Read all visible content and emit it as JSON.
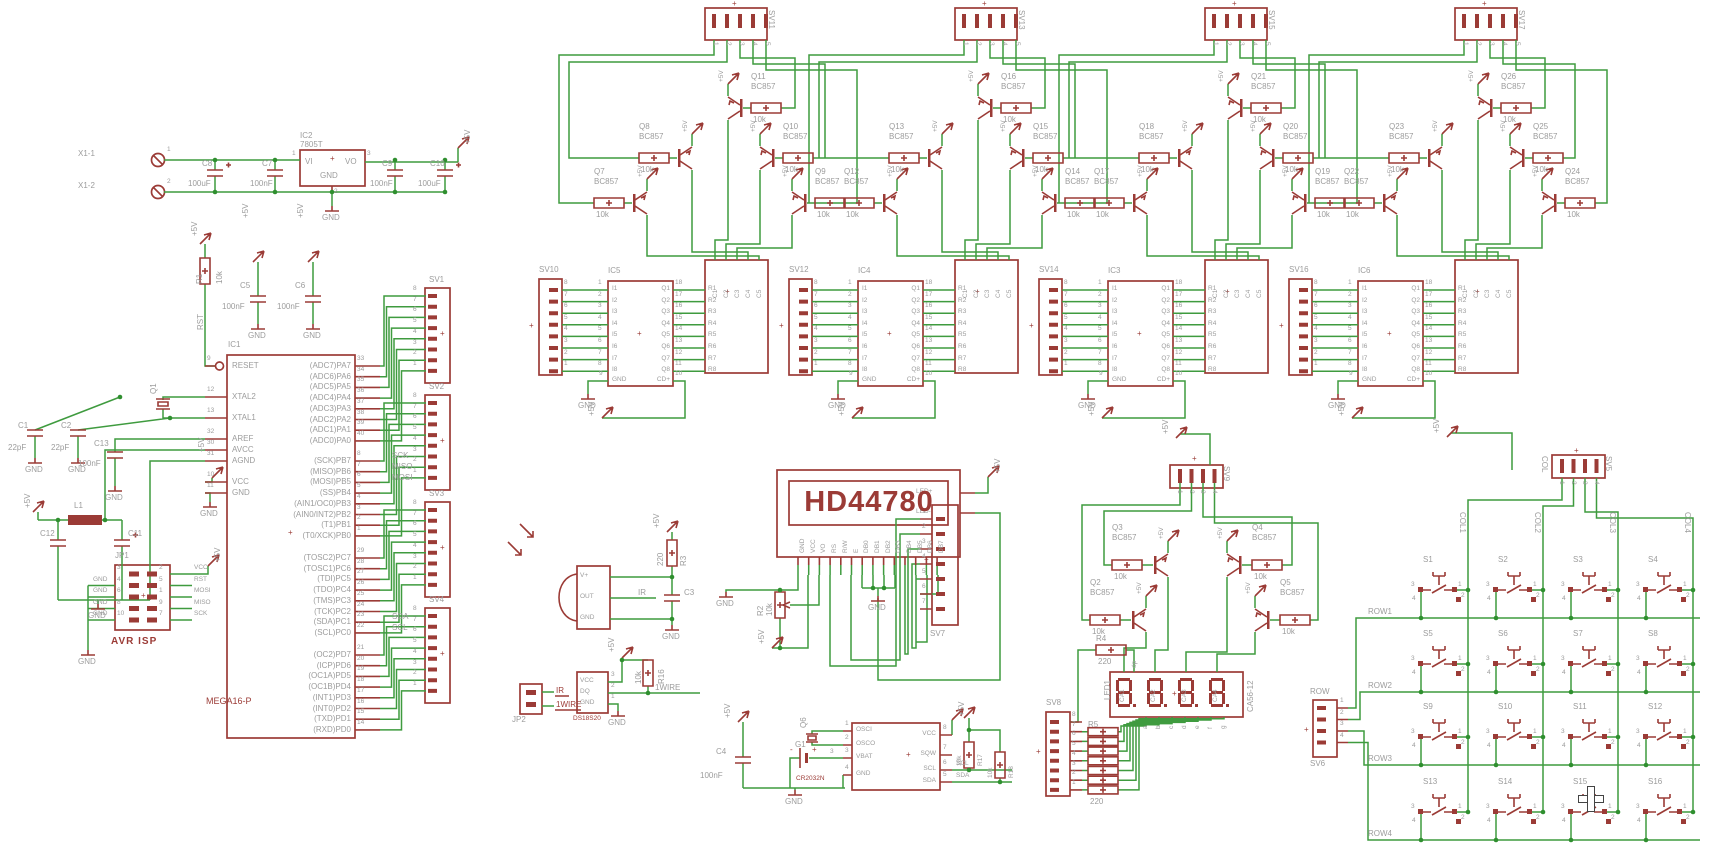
{
  "nets": {
    "p5v": "+5V",
    "gnd": "GND",
    "rst": "RST",
    "sck": "SCK",
    "miso": "MISO",
    "mosi": "MOSI",
    "sda": "SDA",
    "scl": "SCL",
    "ir": "IR",
    "w1": "1WIRE",
    "dp": "dp",
    "plus": "+",
    "minus": "-"
  },
  "power": {
    "x1a": "X1-1",
    "x1b": "X1-2",
    "n1": "1",
    "n2": "2",
    "ic2": {
      "ref": "IC2",
      "value": "7805T",
      "vi": "VI",
      "vo": "VO",
      "gnd": "GND",
      "nvi": "1",
      "nvo": "3",
      "ngnd": "2"
    },
    "c8": [
      "C8",
      "100uF"
    ],
    "c7": [
      "C7",
      "100nF"
    ],
    "c9": [
      "C9",
      "100nF"
    ],
    "c10": [
      "C10",
      "100uF"
    ]
  },
  "reset": {
    "ref": "R1",
    "value": "10k"
  },
  "dec": {
    "c5": [
      "C5",
      "100nF"
    ],
    "c6": [
      "C6",
      "100nF"
    ]
  },
  "mcu": {
    "ref": "IC1",
    "value": "MEGA16-P",
    "left": [
      [
        "9",
        "RESET"
      ],
      [
        "12",
        "XTAL2"
      ],
      [
        "13",
        "XTAL1"
      ],
      [
        "32",
        "AREF"
      ],
      [
        "30",
        "AVCC"
      ],
      [
        "31",
        "AGND"
      ],
      [
        "10",
        "VCC"
      ],
      [
        "11",
        "GND"
      ]
    ],
    "pa": [
      [
        "(ADC7)PA7",
        "33"
      ],
      [
        "(ADC6)PA6",
        "34"
      ],
      [
        "(ADC5)PA5",
        "35"
      ],
      [
        "(ADC4)PA4",
        "36"
      ],
      [
        "(ADC3)PA3",
        "37"
      ],
      [
        "(ADC2)PA2",
        "38"
      ],
      [
        "(ADC1)PA1",
        "39"
      ],
      [
        "(ADC0)PA0",
        "40"
      ]
    ],
    "pb": [
      [
        "(SCK)PB7",
        "8"
      ],
      [
        "(MISO)PB6",
        "7"
      ],
      [
        "(MOSI)PB5",
        "6"
      ],
      [
        "(SS)PB4",
        "5"
      ],
      [
        "(AIN1/OC0)PB3",
        "4"
      ],
      [
        "(AIN0/INT2)PB2",
        "3"
      ],
      [
        "(T1)PB1",
        "2"
      ],
      [
        "(T0/XCK)PB0",
        "1"
      ]
    ],
    "pc": [
      [
        "(TOSC2)PC7",
        "29"
      ],
      [
        "(TOSC1)PC6",
        "28"
      ],
      [
        "(TDI)PC5",
        "27"
      ],
      [
        "(TDO)PC4",
        "26"
      ],
      [
        "(TMS)PC3",
        "25"
      ],
      [
        "(TCK)PC2",
        "24"
      ],
      [
        "(SDA)PC1",
        "23"
      ],
      [
        "(SCL)PC0",
        "22"
      ]
    ],
    "pd": [
      [
        "(OC2)PD7",
        "21"
      ],
      [
        "(ICP)PD6",
        "20"
      ],
      [
        "(OC1A)PD5",
        "19"
      ],
      [
        "(OC1B)PD4",
        "18"
      ],
      [
        "(INT1)PD3",
        "17"
      ],
      [
        "(INT0)PD2",
        "16"
      ],
      [
        "(TXD)PD1",
        "15"
      ],
      [
        "(RXD)PD0",
        "14"
      ]
    ],
    "sv": [
      "SV1",
      "SV2",
      "SV3",
      "SV4"
    ],
    "svpins": [
      "8",
      "7",
      "6",
      "5",
      "4",
      "3",
      "2",
      "1"
    ]
  },
  "xtal": {
    "q": "Q1",
    "c1": [
      "C1",
      "22pF"
    ],
    "c2": [
      "C2",
      "22pF"
    ],
    "c13": [
      "C13",
      "100nF"
    ]
  },
  "lc": {
    "l1": "L1",
    "c12": "C12",
    "c11": "C11"
  },
  "isp": {
    "ref": "JP1",
    "caption": "AVR ISP",
    "rows": [
      [
        "3",
        "2"
      ],
      [
        "4",
        "5"
      ],
      [
        "6",
        "1"
      ],
      [
        "8",
        "9"
      ],
      [
        "10",
        "7"
      ]
    ],
    "rnets": [
      "VCC",
      "RST",
      "MOSI",
      "MISO",
      "SCK"
    ],
    "lnet": "GND"
  },
  "blocks": {
    "list": [
      {
        "top": "SV11",
        "conn": "SV10",
        "ic": "IC5",
        "t": [
          [
            "Q7",
            "R27"
          ],
          [
            "Q8",
            "R28"
          ],
          [
            "Q11",
            "R31"
          ],
          [
            "Q10",
            "R30"
          ],
          [
            "Q9",
            "R29"
          ]
        ]
      },
      {
        "top": "SV13",
        "conn": "SV12",
        "ic": "IC4",
        "t": [
          [
            "Q12",
            "R40"
          ],
          [
            "Q13",
            "R41"
          ],
          [
            "Q16",
            "R44"
          ],
          [
            "Q15",
            "R43"
          ],
          [
            "Q14",
            "R42"
          ]
        ]
      },
      {
        "top": "SV15",
        "conn": "SV14",
        "ic": "IC3",
        "t": [
          [
            "Q17",
            "R53"
          ],
          [
            "Q18",
            "R54"
          ],
          [
            "Q21",
            "R57"
          ],
          [
            "Q20",
            "R56"
          ],
          [
            "Q19",
            "R55"
          ]
        ]
      },
      {
        "top": "SV17",
        "conn": "SV16",
        "ic": "IC6",
        "t": [
          [
            "Q22",
            "R66"
          ],
          [
            "Q23",
            "R67"
          ],
          [
            "Q26",
            "R70"
          ],
          [
            "Q25",
            "R69"
          ],
          [
            "Q24",
            "R68"
          ]
        ]
      }
    ],
    "ttype": "BC857",
    "rval": "10k",
    "in": [
      "I1",
      "I2",
      "I3",
      "I4",
      "I5",
      "I6",
      "I7",
      "I8"
    ],
    "innum": [
      "1",
      "2",
      "3",
      "4",
      "5",
      "6",
      "7",
      "8"
    ],
    "out": [
      "Q1",
      "Q2",
      "Q3",
      "Q4",
      "Q5",
      "Q6",
      "Q7",
      "Q8"
    ],
    "outnum": [
      "18",
      "17",
      "16",
      "15",
      "14",
      "13",
      "12",
      "11"
    ],
    "gnd": "GND",
    "ngnd": "9",
    "cdp": "CD+",
    "ncdp": "10",
    "mr": [
      "R1",
      "R2",
      "R3",
      "R4",
      "R5",
      "R6",
      "R7",
      "R8"
    ],
    "mc": [
      "C1",
      "C2",
      "C3",
      "C4",
      "C5"
    ],
    "cpins": [
      "8",
      "7",
      "6",
      "5",
      "4",
      "3",
      "2",
      "1"
    ],
    "tpins": [
      "1",
      "2",
      "3",
      "4",
      "5"
    ]
  },
  "lcd": {
    "title": "HD44780",
    "bottom": [
      "GND",
      "VCC",
      "VO",
      "RS",
      "R/W",
      "E",
      "DB0",
      "DB1",
      "DB2",
      "DB3",
      "DB4",
      "DB5",
      "DB6",
      "DB7"
    ],
    "ledp": "LED+",
    "ledm": "LED-",
    "pot": [
      "R2",
      "10k"
    ],
    "sv7": {
      "name": "SV7",
      "pins": [
        "1",
        "2",
        "3",
        "4",
        "5",
        "6",
        "7"
      ]
    }
  },
  "ir": {
    "vp": "V+",
    "out": "OUT",
    "gnd": "GND",
    "r3": [
      "R3",
      "220"
    ],
    "c3": "C3"
  },
  "ow": {
    "dev": "DS18S20",
    "vcc": "VCC",
    "dq": "DQ",
    "gnd": "GND",
    "nums": [
      "3",
      "2",
      "1"
    ],
    "r16": [
      "R16",
      "10k"
    ]
  },
  "jp2": {
    "ref": "JP2"
  },
  "rtc": {
    "lnames": [
      "OSCI",
      "OSCO",
      "VBAT",
      "GND"
    ],
    "lnums": [
      "1",
      "2",
      "3",
      "4"
    ],
    "rnames": [
      "VCC",
      "SQW",
      "SCL",
      "SDA"
    ],
    "rnums": [
      "8",
      "7",
      "6",
      "5"
    ],
    "q6": "Q6",
    "g1": [
      "G1",
      "CR2032N"
    ],
    "c4": [
      "C4",
      "100nF"
    ],
    "r17": [
      "R17",
      "10k"
    ],
    "r18": [
      "R18",
      "10k"
    ]
  },
  "seg": {
    "sv9": {
      "name": "SV9",
      "pins": [
        "1",
        "2",
        "3",
        "4"
      ]
    },
    "t": [
      [
        "Q2",
        "R12"
      ],
      [
        "Q3",
        "R13"
      ],
      [
        "Q4",
        "R14"
      ],
      [
        "Q5",
        "R15"
      ]
    ],
    "ttype": "BC857",
    "rval": "10k",
    "r4": [
      "R4",
      "220"
    ],
    "led": {
      "ref": "LED1",
      "value": "CA56-12",
      "ca": [
        "CA1",
        "CA2",
        "CA3",
        "CA4"
      ],
      "segs": [
        "a",
        "b",
        "c",
        "d",
        "e",
        "f",
        "g"
      ]
    },
    "sv8": {
      "name": "SV8",
      "pins": [
        "8",
        "7",
        "6",
        "5",
        "4",
        "3",
        "2",
        "1"
      ]
    },
    "r5": [
      "R5",
      "220"
    ]
  },
  "keypad": {
    "sv5": {
      "name": "SV5",
      "group": "COL",
      "pins": [
        "1",
        "2",
        "3",
        "4"
      ]
    },
    "sv6": {
      "name": "SV6",
      "group": "ROW",
      "pins": [
        "1",
        "2",
        "3",
        "4"
      ]
    },
    "rows": [
      "ROW1",
      "ROW2",
      "ROW3",
      "ROW4"
    ],
    "cols": [
      "COL1",
      "COL2",
      "COL3",
      "COL4"
    ],
    "sw": [
      "S1",
      "S2",
      "S3",
      "S4",
      "S5",
      "S6",
      "S7",
      "S8",
      "S9",
      "S10",
      "S11",
      "S12",
      "S13",
      "S14",
      "S15",
      "S16"
    ],
    "swpins": [
      "3",
      "1",
      "2",
      "4"
    ]
  },
  "colors": {
    "wire": "#3F9B3F",
    "part": "#9B3B36",
    "label": "#9C9C9C",
    "dot": "#2F8F2F",
    "bg": "#FFFFFF"
  }
}
